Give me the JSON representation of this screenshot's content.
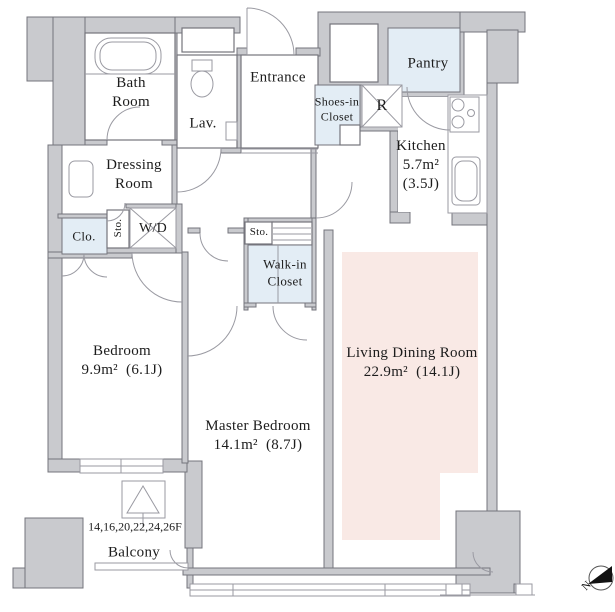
{
  "title": "Apartment floor plan",
  "colors": {
    "wall": "#c9cace",
    "outline": "#74747c",
    "blue": "#e3edf5",
    "pink": "#f9e9e5",
    "text": "#1c1c1c"
  },
  "labels": {
    "bath_room": "Bath\nRoom",
    "lav": "Lav.",
    "entrance": "Entrance",
    "shoes_in_closet": "Shoes-in\nCloset",
    "refrigerator": "R",
    "pantry": "Pantry",
    "kitchen": "Kitchen\n5.7m²\n(3.5J)",
    "dressing_room": "Dressing\nRoom",
    "closet": "Clo.",
    "storage_1": "Sto.",
    "washer_dryer": "W/D",
    "storage_2": "Sto.",
    "walk_in_closet": "Walk-in\nCloset",
    "bedroom": "Bedroom\n9.9m²  (6.1J)",
    "master_bedroom": "Master Bedroom\n14.1m²  (8.7J)",
    "living_dining_room": "Living Dining Room\n22.9m²  (14.1J)",
    "floors": "14,16,20,22,24,26F",
    "balcony": "Balcony",
    "compass_north": "N"
  }
}
